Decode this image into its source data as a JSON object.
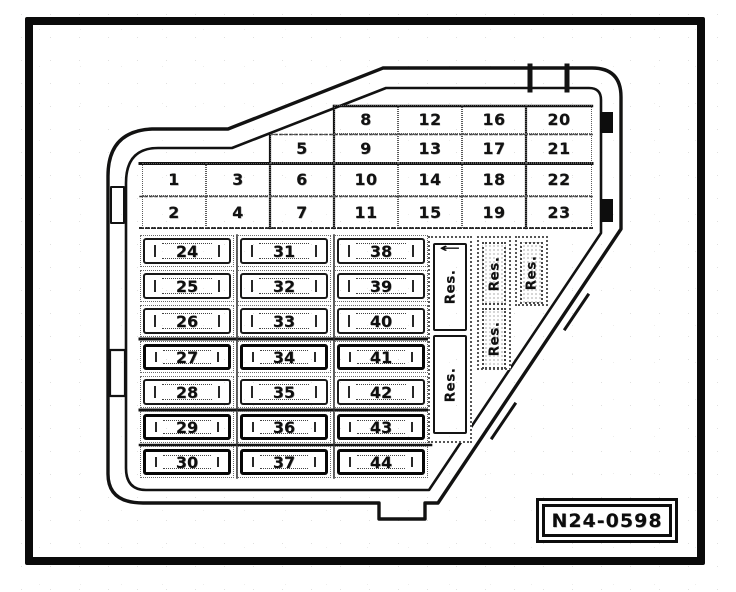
{
  "figure": {
    "part_number": "N24-0598",
    "ink_color": "#111111",
    "paper_color": "#fdfdfc"
  },
  "upper_fuse_grid": {
    "rows": [
      {
        "start_col": 3,
        "numbers": [
          "8",
          "12",
          "16",
          "20"
        ]
      },
      {
        "start_col": 2,
        "numbers": [
          "5",
          "9",
          "13",
          "17",
          "21"
        ]
      },
      {
        "start_col": 0,
        "numbers": [
          "1",
          "3",
          "6",
          "10",
          "14",
          "18",
          "22"
        ]
      },
      {
        "start_col": 0,
        "numbers": [
          "2",
          "4",
          "7",
          "11",
          "15",
          "19",
          "23"
        ]
      }
    ]
  },
  "lower_fuse_grid": {
    "columns": [
      {
        "numbers": [
          "24",
          "25",
          "26",
          "27",
          "28",
          "29",
          "30"
        ]
      },
      {
        "numbers": [
          "31",
          "32",
          "33",
          "34",
          "35",
          "36",
          "37"
        ]
      },
      {
        "numbers": [
          "38",
          "39",
          "40",
          "41",
          "42",
          "43",
          "44"
        ]
      }
    ]
  },
  "reserve_strips": [
    {
      "slots": [
        {
          "label": "Res.",
          "icon": "left-arrow-icon"
        },
        {
          "label": "Res."
        }
      ]
    },
    {
      "slots": [
        {
          "label": "Res."
        },
        {
          "label": "Res."
        }
      ]
    },
    {
      "slots": [
        {
          "label": "Res."
        }
      ]
    }
  ]
}
